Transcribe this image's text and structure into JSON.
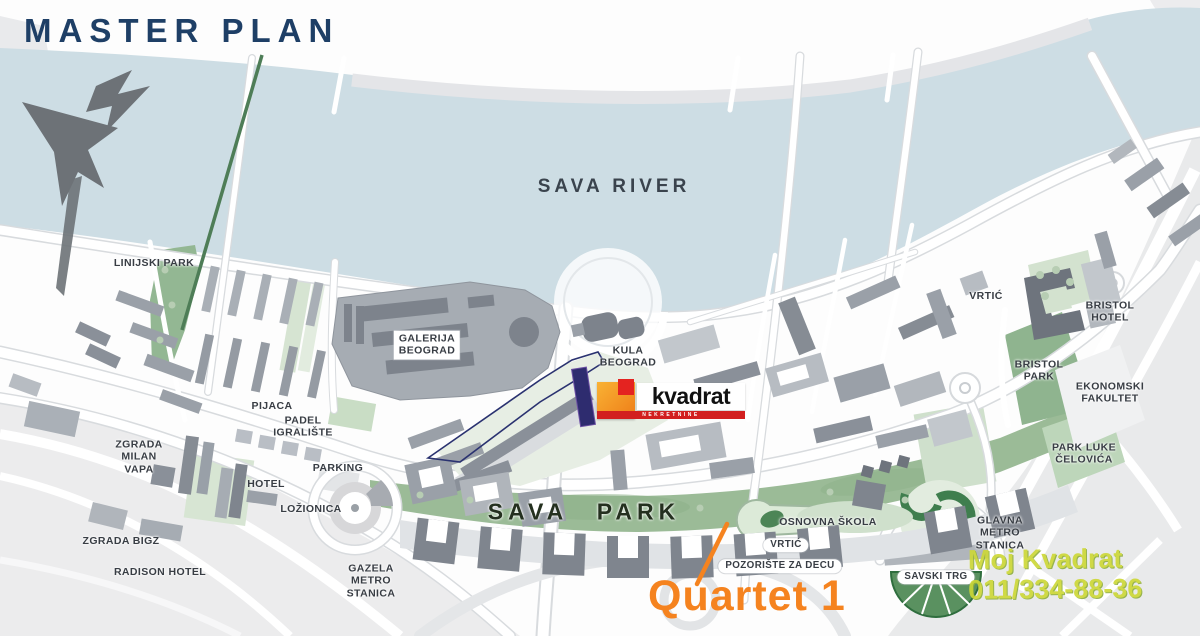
{
  "title": "MASTER PLAN",
  "colors": {
    "title_navy": "#1e3f66",
    "river_blue": "#cddde4",
    "park_green": "#9bbb97",
    "accent_orange": "#f5831f",
    "brand_orange": "#ee7d18",
    "brand_red": "#d21f1f",
    "plot_navy": "#2e2c6f",
    "watermark_green": "#cdd835"
  },
  "icons": {
    "compass": "north-arrow-icon"
  },
  "map": {
    "labels": [
      {
        "id": "sava-river",
        "text": "SAVA RIVER",
        "x": 614,
        "y": 187,
        "style": "river"
      },
      {
        "id": "linijski-park",
        "text": "LINIJSKI PARK",
        "x": 154,
        "y": 263,
        "style": "plain"
      },
      {
        "id": "galerija-beograd",
        "text": "GALERIJA\nBEOGRAD",
        "x": 427,
        "y": 345,
        "style": "boxed"
      },
      {
        "id": "kula-beograd",
        "text": "KULA\nBEOGRAD",
        "x": 628,
        "y": 357,
        "style": "plain"
      },
      {
        "id": "pijaca",
        "text": "PIJACA",
        "x": 272,
        "y": 406,
        "style": "plain"
      },
      {
        "id": "padel-igraliste",
        "text": "PADEL\nIGRALIŠTE",
        "x": 303,
        "y": 427,
        "style": "plain"
      },
      {
        "id": "zgrada-milan-vapa",
        "text": "ZGRADA\nMILAN\nVAPA",
        "x": 139,
        "y": 457,
        "style": "plain"
      },
      {
        "id": "hotel",
        "text": "HOTEL",
        "x": 266,
        "y": 484,
        "style": "plain"
      },
      {
        "id": "parking",
        "text": "PARKING",
        "x": 338,
        "y": 468,
        "style": "plain"
      },
      {
        "id": "lozionica",
        "text": "LOŽIONICA",
        "x": 311,
        "y": 509,
        "style": "plain"
      },
      {
        "id": "zgrada-bigz",
        "text": "ZGRADA BIGZ",
        "x": 121,
        "y": 541,
        "style": "plain"
      },
      {
        "id": "radison-hotel",
        "text": "RADISON HOTEL",
        "x": 160,
        "y": 572,
        "style": "plain"
      },
      {
        "id": "gazela-metro-stanica",
        "text": "GAZELA\nMETRO\nSTANICA",
        "x": 371,
        "y": 581,
        "style": "plain"
      },
      {
        "id": "sava-park",
        "text": "SAVA PARK",
        "x": 584,
        "y": 512,
        "style": "park-big"
      },
      {
        "id": "osnovna-skola",
        "text": "OSNOVNA ŠKOLA",
        "x": 828,
        "y": 522,
        "style": "plain"
      },
      {
        "id": "vrtic-south",
        "text": "VRTIĆ",
        "x": 786,
        "y": 545,
        "style": "boxed-sm"
      },
      {
        "id": "pozoriste-za-decu",
        "text": "POZORIŠTE ZA DECU",
        "x": 780,
        "y": 566,
        "style": "boxed-sm"
      },
      {
        "id": "savski-trg",
        "text": "SAVSKI TRG",
        "x": 936,
        "y": 577,
        "style": "boxed-sm"
      },
      {
        "id": "glavna-metro-stanica",
        "text": "GLAVNA\nMETRO\nSTANICA",
        "x": 1000,
        "y": 533,
        "style": "plain"
      },
      {
        "id": "vrtic-north",
        "text": "VRTIĆ",
        "x": 986,
        "y": 296,
        "style": "plain"
      },
      {
        "id": "bristol-hotel",
        "text": "BRISTOL\nHOTEL",
        "x": 1110,
        "y": 312,
        "style": "plain"
      },
      {
        "id": "bristol-park",
        "text": "BRISTOL\nPARK",
        "x": 1039,
        "y": 371,
        "style": "plain"
      },
      {
        "id": "ekonomski-fakultet",
        "text": "EKONOMSKI\nFAKULTET",
        "x": 1110,
        "y": 393,
        "style": "plain"
      },
      {
        "id": "park-luke-celovica",
        "text": "PARK LUKE\nČELOVIĆA",
        "x": 1084,
        "y": 454,
        "style": "plain"
      }
    ]
  },
  "logo": {
    "wordmark": "kvadrat",
    "tagline": "NEKRETNINE"
  },
  "annotation": {
    "label": "Quartet 1"
  },
  "watermark": {
    "line1": "Moj Kvadrat",
    "line2": "011/334-88-36"
  }
}
